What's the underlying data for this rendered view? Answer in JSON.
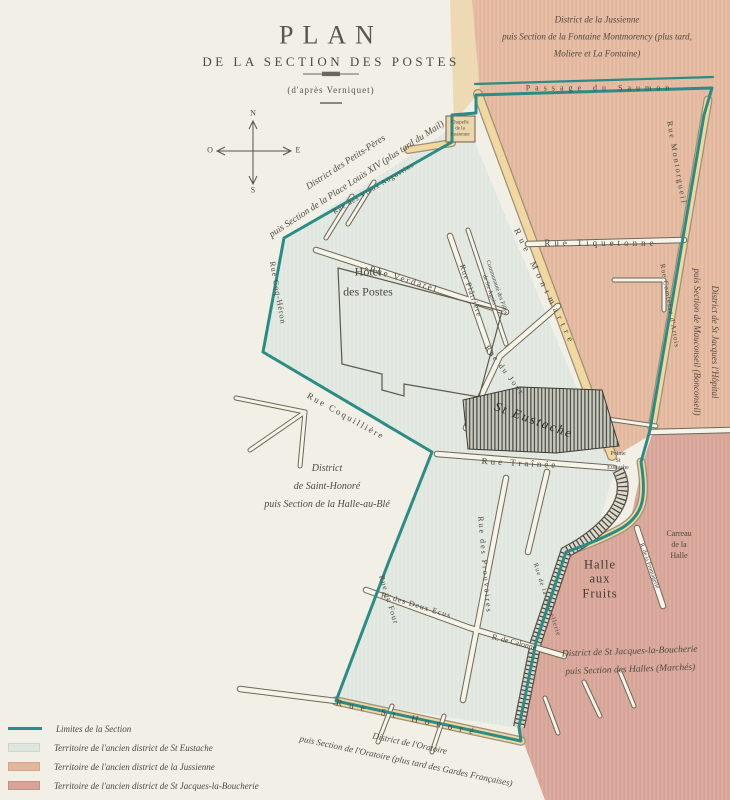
{
  "title": {
    "main": "PLAN",
    "subtitle": "DE LA SECTION DES POSTES",
    "attribution": "(d'après Verniquet)"
  },
  "compass": {
    "north": "N",
    "south": "S",
    "east": "E",
    "west": "O"
  },
  "districts": {
    "jussienne": "District de la Jussienne\npuis Section de la Fontaine Montmorency (plus tard,\nMoliere et La Fontaine)",
    "petits_peres": "District des Petits-Pères\npuis Section de la Place Louis XIV (plus tard du Mail)",
    "st_jacques_hopital": "District de St Jacques l'Hôpital\npuis Section de Mauconseil (Bonconseil)",
    "saint_honore": "District\nde Saint-Honoré\npuis Section de la Halle-au-Blé",
    "st_jacques_boucherie": "District de St Jacques-la-Boucherie\npuis Section des Halles (Marchés)",
    "oratoire": "District de l'Oratoire\npuis Section de l'Oratoire (plus tard des Gardes Françaises)"
  },
  "places": {
    "hotel_des_postes": "Hôtel\ndes Postes",
    "st_eustache": "St Eustache",
    "chapelle_jussienne": "Chapelle\nde la\nJussienne",
    "halle_aux_fruits": "Halle\naux\nFruits",
    "carreau_halle": "Carreau\nde la\nHalle",
    "pointe_st_eustache": "Pointe\nSt\nEustache",
    "communaute": "Communauté des Filles\nde Ste Agnès"
  },
  "streets": {
    "passage_saumon": "Passage du Saumon",
    "montorgueil": "Rue Montorgueil",
    "comtesse_artois": "Rue Comtesse d'Artois",
    "tiquetonne": "Rue Tiquetonne",
    "montmartre": "Rue Montmartre",
    "verdarel": "Rue Verdarel",
    "platriere": "Rue Plâtrière",
    "jour": "Rue du Jour",
    "coquilliere": "Rue Coquillière",
    "coq_heron": "Rue Coq-Héron",
    "vieux_augustins": "Rue des Vieux Augustins",
    "trainee": "Rue Traînée",
    "prouvaires": "Rue des Prouvaires",
    "deux_ecus": "R. des Deux Ecus",
    "calonne": "R. de Calonne",
    "four": "Rue du Four",
    "st_honore": "Rue St Honoré",
    "fromagerie": "R. de la Fromagerie",
    "tonnellerie": "Rue de la Tonnellerie"
  },
  "legend": {
    "items": [
      {
        "label": "Limites de la Section",
        "swatch": "boundary-line"
      },
      {
        "label": "Territoire de l'ancien district de St Eustache",
        "swatch": "green"
      },
      {
        "label": "Territoire de l'ancien district de la Jussienne",
        "swatch": "salmon"
      },
      {
        "label": "Territoire de l'ancien district de St Jacques-la-Boucherie",
        "swatch": "rose"
      }
    ]
  },
  "colors": {
    "paper": "#f2efe6",
    "boundary_teal": "#2b8c86",
    "district_st_eustache": "#dfe6df",
    "district_jussienne": "#e3b69e",
    "district_st_jacques_boucherie": "#d7a498",
    "street_yellow": "#f1d8a0"
  }
}
